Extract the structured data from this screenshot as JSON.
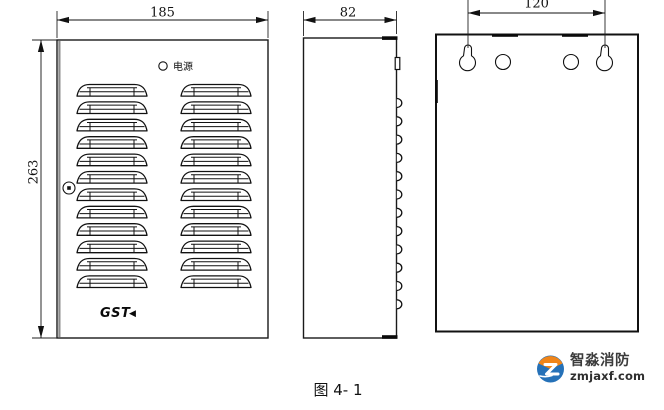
{
  "figure": {
    "caption": "图 4- 1"
  },
  "dimensions": {
    "front_width": "185",
    "front_height": "263",
    "side_depth": "82",
    "mount_hole_spacing": "120"
  },
  "front_view": {
    "led_label": "电源",
    "logo_text": "GST",
    "logo_mark": "◀",
    "louver_rows": 12,
    "louver_columns": 2
  },
  "side_view": {
    "bump_count": 12
  },
  "back_view": {
    "keyhole_count": 2,
    "round_hole_count": 2
  },
  "watermark": {
    "brand": "智淼消防",
    "domain": "zmjaxf.com",
    "colors": {
      "orange": "#f08519",
      "blue": "#2571b8"
    }
  }
}
